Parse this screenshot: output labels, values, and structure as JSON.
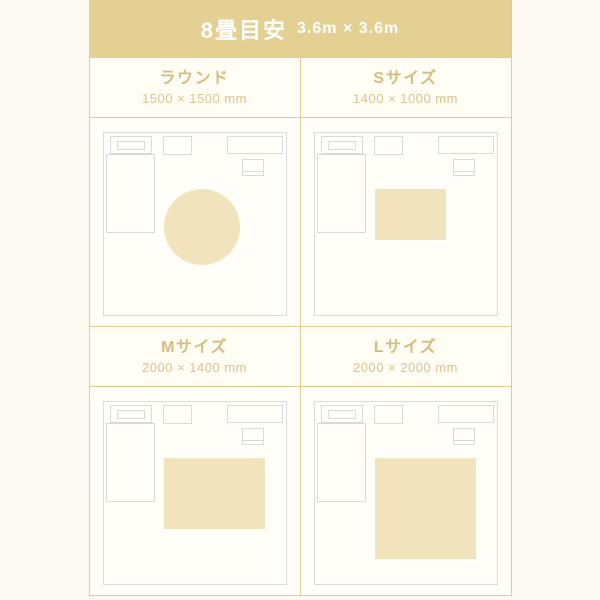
{
  "header": {
    "title": "8畳目安",
    "subtitle": "3.6m × 3.6m"
  },
  "room": {
    "width_mm": 3600,
    "height_mm": 3600
  },
  "panels": [
    {
      "label": "ラウンド",
      "size_label": "1500 × 1500 mm",
      "rug_shape": "circle",
      "rug_width_mm": 1500,
      "rug_height_mm": 1500
    },
    {
      "label": "Sサイズ",
      "size_label": "1400 × 1000 mm",
      "rug_shape": "rect",
      "rug_width_mm": 1400,
      "rug_height_mm": 1000
    },
    {
      "label": "Mサイズ",
      "size_label": "2000 × 1400 mm",
      "rug_shape": "rect",
      "rug_width_mm": 2000,
      "rug_height_mm": 1400
    },
    {
      "label": "Lサイズ",
      "size_label": "2000 × 2000 mm",
      "rug_shape": "rect",
      "rug_width_mm": 2000,
      "rug_height_mm": 2000
    }
  ],
  "colors": {
    "accent_tan": "#E5D094",
    "border_tan": "#E2CC94",
    "label_tan": "#D8BB80",
    "sublabel_tan": "#DDC28C",
    "rug_fill": "#F1E4BD",
    "outline_gray": "#DADADA",
    "page_bg": "#FCFAF2",
    "card_bg": "#FFFEF8",
    "header_text": "#FFFFFF"
  }
}
